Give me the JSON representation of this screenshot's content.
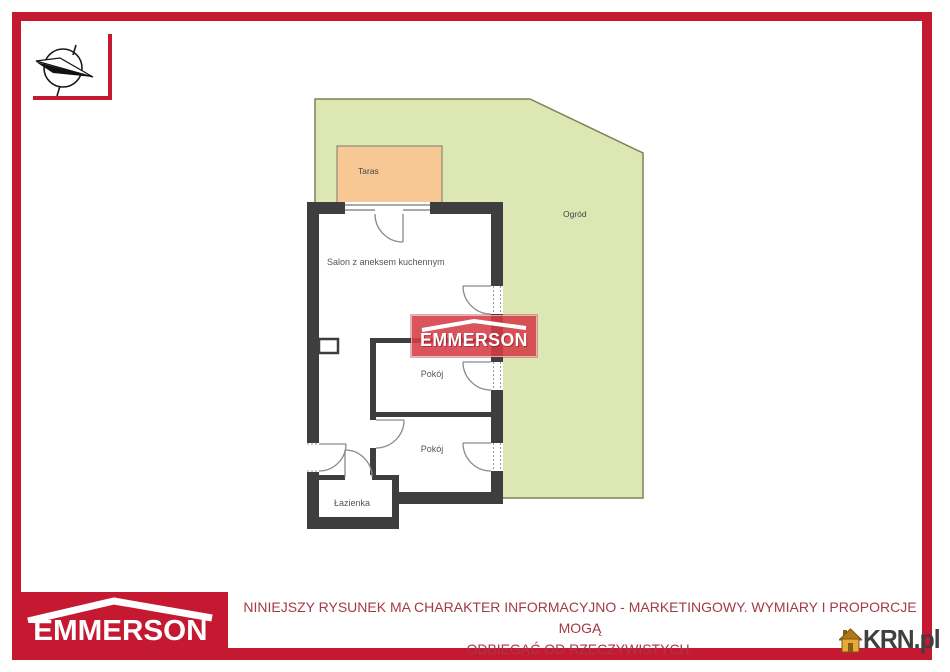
{
  "frame": {
    "border_color": "#C41931"
  },
  "compass": {
    "icon": "compass-north-icon"
  },
  "plan": {
    "garden": {
      "label": "Ogród",
      "fill": "#DCE7B4",
      "border": "#7E8157"
    },
    "terrace": {
      "label": "Taras",
      "fill": "#F7C794",
      "border": "#8B8B7A"
    },
    "rooms": {
      "salon": {
        "label": "Salon z aneksem kuchennym"
      },
      "room1": {
        "label": "Pokój"
      },
      "room2": {
        "label": "Pokój"
      },
      "bathroom": {
        "label": "Łazienka"
      }
    },
    "wall_color": "#3E3E3E"
  },
  "watermark_banner": {
    "brand": "EMMERSON",
    "color": "#D43C46"
  },
  "footer": {
    "logo": {
      "brand": "EMMERSON",
      "background": "#C41931"
    },
    "disclaimer_line1": "NINIEJSZY RYSUNEK MA CHARAKTER INFORMACYJNO - MARKETINGOWY. WYMIARY I PROPORCJE MOGĄ",
    "disclaimer_line2": "ODBIEGAĆ OD RZECZYWISTYCH.",
    "text_color": "#A33A46"
  },
  "krn_watermark": {
    "label": "KRN.pl",
    "icon": "house-icon",
    "text_color": "#3F3F3F",
    "icon_color": "#E8A93C"
  }
}
